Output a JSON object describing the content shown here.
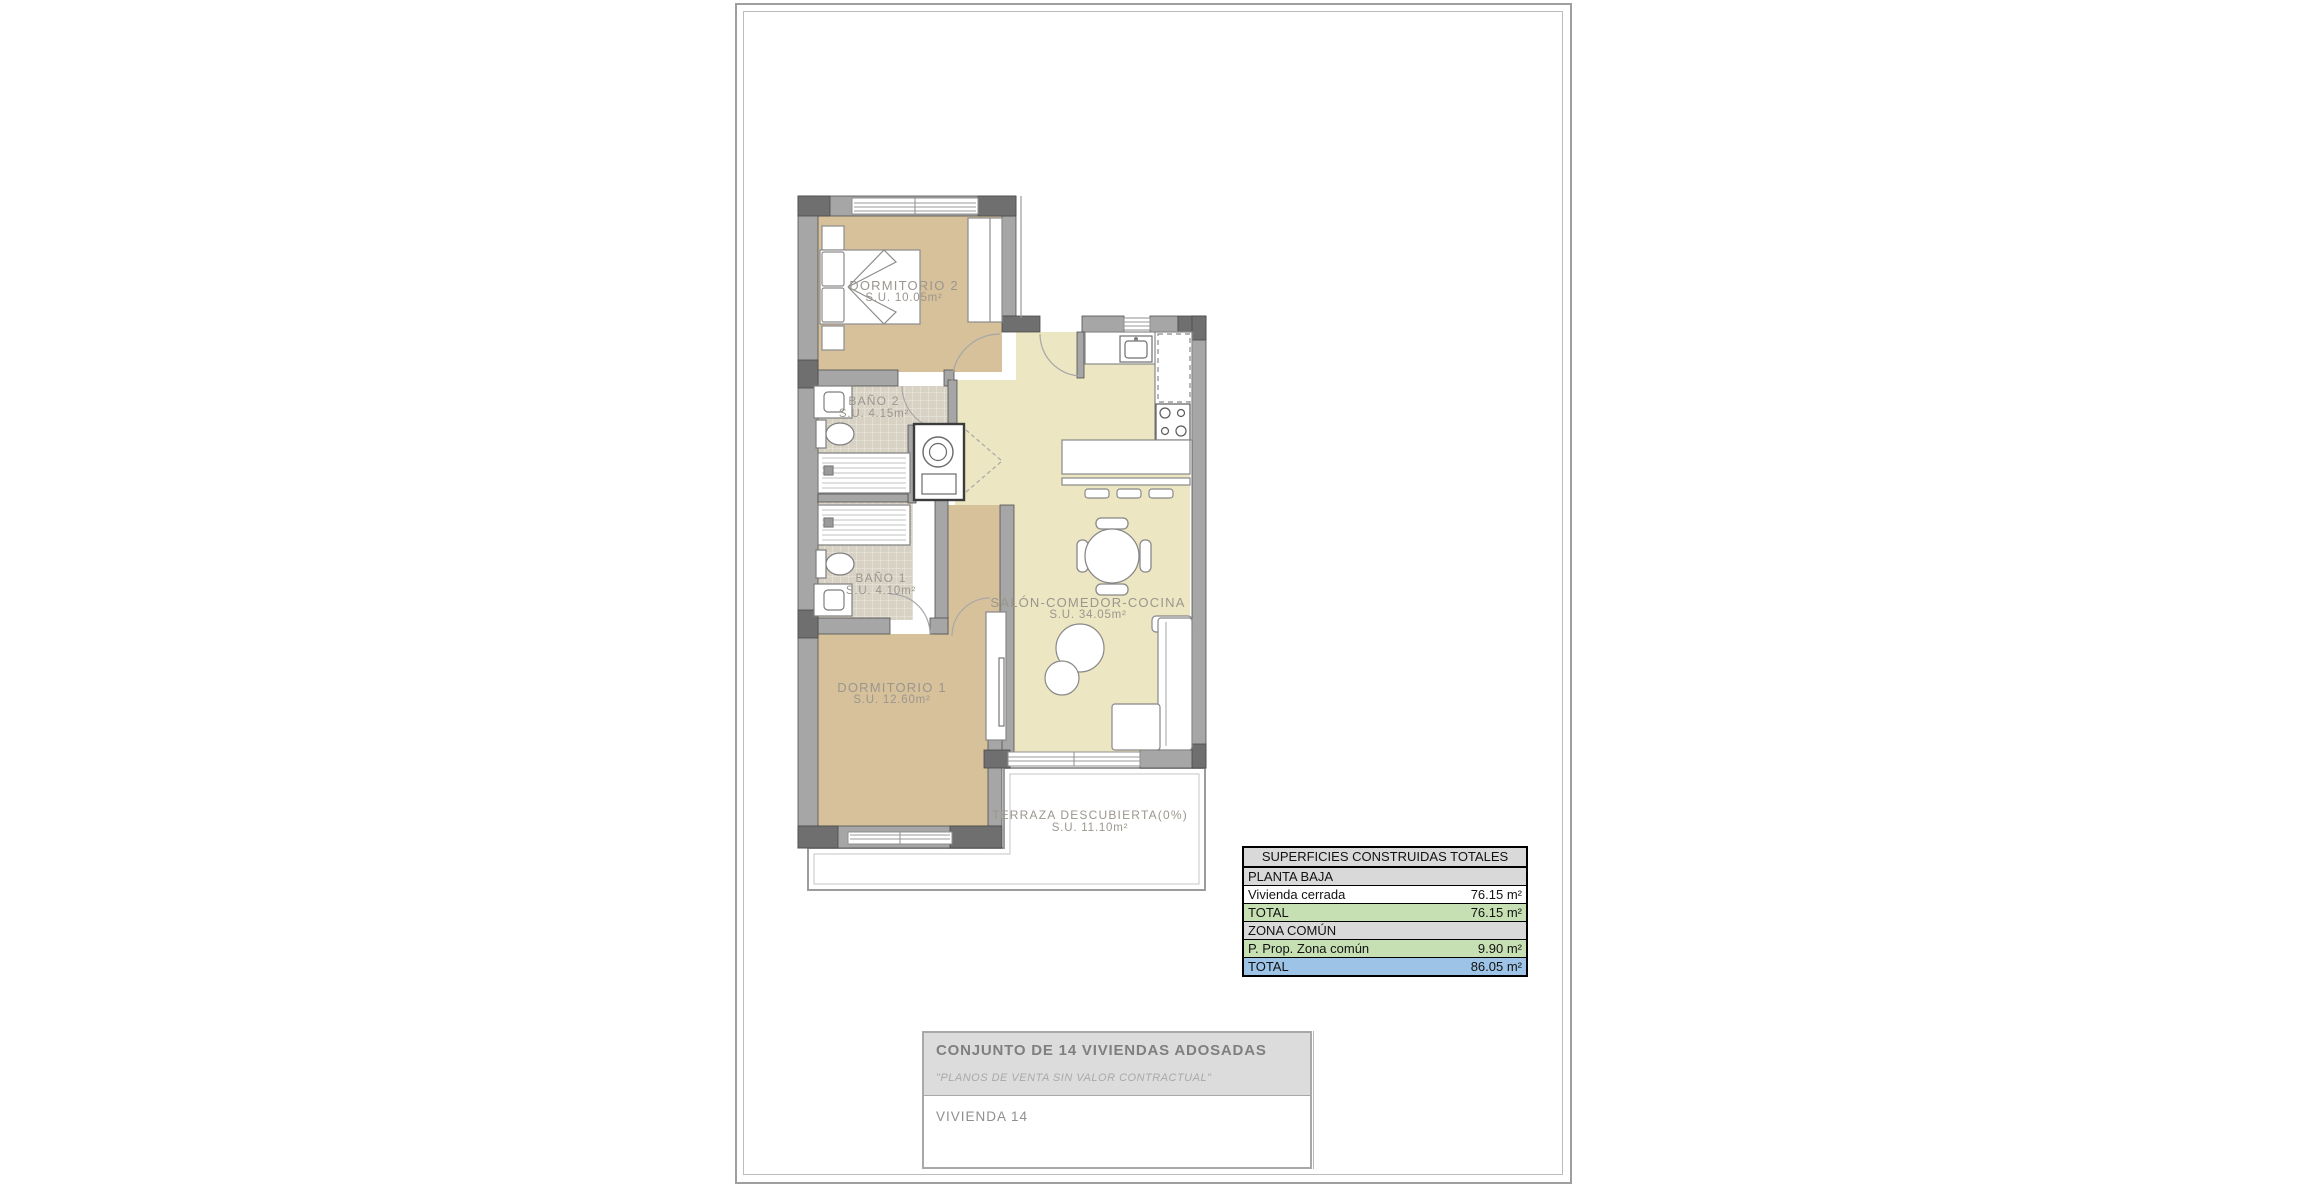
{
  "floor_plan": {
    "rooms": [
      {
        "name": "DORMITORIO 2",
        "area": "S.U. 10.05m²"
      },
      {
        "name": "BAÑO 2",
        "area": "S.U. 4.15m²"
      },
      {
        "name": "BAÑO 1",
        "area": "S.U. 4.10m²"
      },
      {
        "name": "DORMITORIO 1",
        "area": "S.U. 12.60m²"
      },
      {
        "name": "SALÓN-COMEDOR-COCINA",
        "area": "S.U. 34.05m²"
      },
      {
        "name": "TERRAZA DESCUBIERTA(0%)",
        "area": "S.U. 11.10m²"
      }
    ],
    "palette": {
      "bedroom_floor": "#d6c19b",
      "living_floor": "#ece6c2",
      "bathroom_floor": "#d8d2c5",
      "wall": "#a6a6a6",
      "wall_dark": "#6f6f6f",
      "label_text": "#9b968e"
    }
  },
  "areas_table": {
    "title": "SUPERFICIES CONSTRUIDAS TOTALES",
    "rows": [
      {
        "label": "PLANTA BAJA",
        "value": "",
        "style": "section"
      },
      {
        "label": "Vivienda cerrada",
        "value": "76.15 m²",
        "style": "plain"
      },
      {
        "label": "TOTAL",
        "value": "76.15 m²",
        "style": "subtotal"
      },
      {
        "label": "ZONA COMÚN",
        "value": "",
        "style": "section"
      },
      {
        "label": "P. Prop. Zona común",
        "value": "9.90 m²",
        "style": "subtotal"
      },
      {
        "label": "TOTAL",
        "value": "86.05 m²",
        "style": "total"
      }
    ],
    "colors": {
      "section_bg": "#d9d9d9",
      "subtotal_bg": "#c6e0b4",
      "total_bg": "#9dc3e6"
    }
  },
  "title_block": {
    "project": "CONJUNTO DE 14 VIVIENDAS ADOSADAS",
    "disclaimer": "\"PLANOS DE VENTA SIN VALOR CONTRACTUAL\"",
    "unit": "VIVIENDA 14"
  }
}
